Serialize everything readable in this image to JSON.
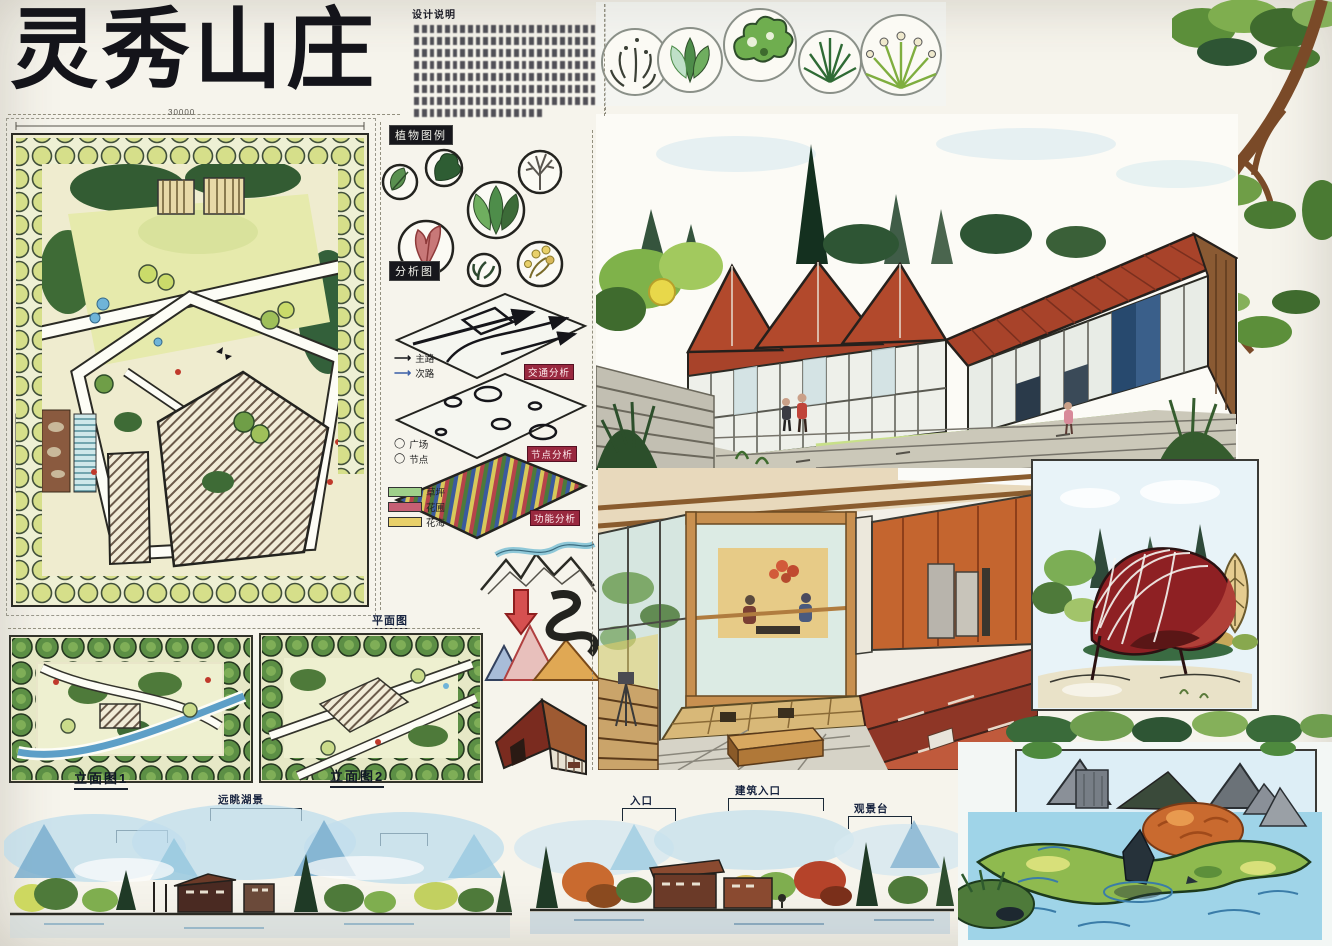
{
  "board": {
    "title": "灵秀山庄",
    "notes_heading": "设计说明",
    "master_plan_dimension": "30000",
    "tags": {
      "plant_legend": "植物图例",
      "analysis": "分析图",
      "traffic": "交通分析",
      "nodes": "节点分析",
      "function": "功能分析",
      "plan_thumb": "平面图"
    },
    "legends": {
      "roads": [
        {
          "label": "主路"
        },
        {
          "label": "次路"
        }
      ],
      "nodes": [
        {
          "label": "广场"
        },
        {
          "label": "节点"
        }
      ],
      "zones": [
        {
          "label": "草坪",
          "color": "#9fd08a"
        },
        {
          "label": "花圃",
          "color": "#c65f74"
        },
        {
          "label": "花海",
          "color": "#e8d06a"
        }
      ]
    },
    "annotations": {
      "elevation1": "立面图1",
      "elevation2": "立面图2",
      "lake_view": "远眺湖景",
      "entry": "入口",
      "building_entry": "建筑入口",
      "view_deck": "观景台"
    },
    "palette": {
      "roof_rust": "#a8432a",
      "lawn_green": "#8fc257",
      "water_blue": "#9fd4e8",
      "shell_red": "#8e2023",
      "paper": "#f6f4ec"
    }
  }
}
